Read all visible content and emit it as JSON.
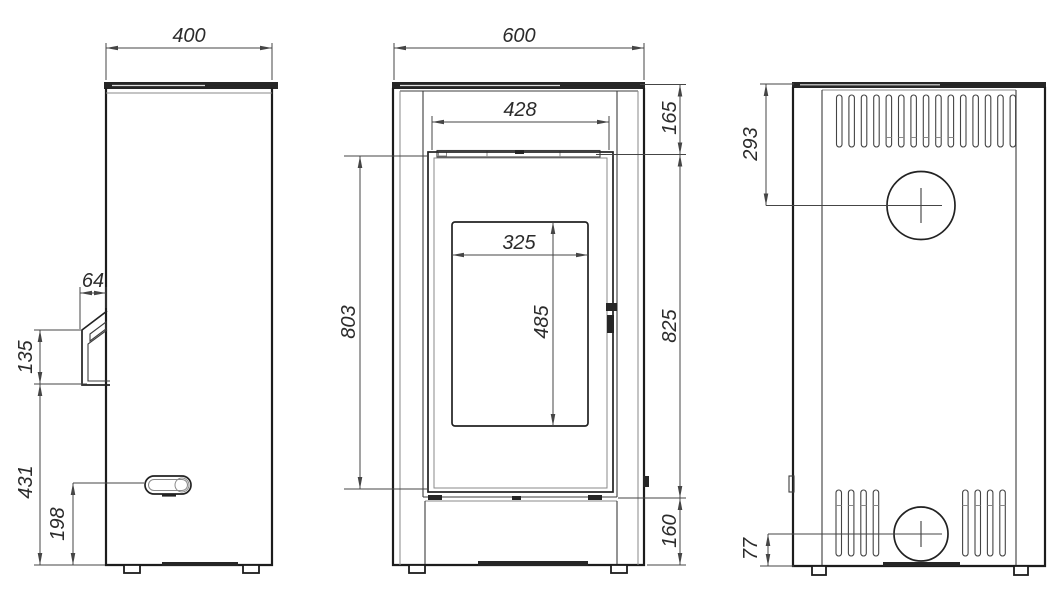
{
  "dimensions_mm": {
    "side": {
      "width": "400",
      "handle_depth": "64",
      "handle_length": "135",
      "handle_bottom_above_floor": "431",
      "lever_above_floor": "198"
    },
    "front": {
      "width": "600",
      "top_opening_width": "428",
      "top_section_height": "165",
      "glass_width": "325",
      "glass_height": "485",
      "door_height": "803",
      "middle_section_height": "825",
      "base_height": "160"
    },
    "back": {
      "flue_center_below_top": "293",
      "inlet_center_above_floor": "77"
    }
  },
  "back_view": {
    "top_vent_slot_count": 15,
    "bottom_vent_slot_groups": [
      4,
      4
    ]
  }
}
